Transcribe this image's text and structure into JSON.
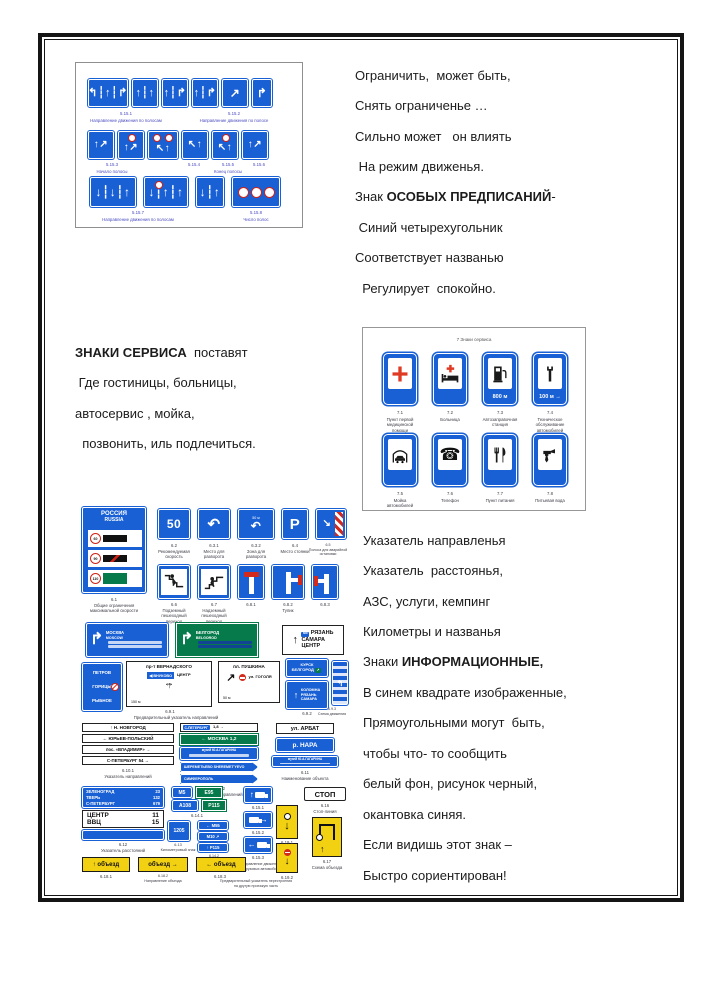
{
  "colors": {
    "sign_blue": "#1960d5",
    "sign_green": "#067a4b",
    "sign_yellow": "#f2d012",
    "cross_red": "#df3a23",
    "frame_black": "#151515"
  },
  "poem_pred": {
    "l1": "Ограничить,  может быть,",
    "l2": "Снять ограниченье …",
    "l3": "Сильно может   он влиять",
    "l4": " На режим движенья.",
    "l5a": "Знак ",
    "l5b": "ОСОБЫХ ПРЕДПИСАНИЙ",
    "l5c": "-",
    "l6": " Синий четырехугольник",
    "l7": "Соответствует названью",
    "l8": "  Регулирует  спокойно."
  },
  "poem_service": {
    "l1a": "ЗНАКИ СЕРВИСА",
    "l1b": "  поставят",
    "l2": " Где гостиницы, больницы,",
    "l3": "автосервис , мойка,",
    "l4": "  позвонить, иль подлечиться."
  },
  "poem_info": {
    "l1": "Указатель направленья",
    "l2": "Указатель  расстоянья,",
    "l3": "АЗС, услуги, кемпинг",
    "l4": "Километры и названья",
    "l5a": "Знаки ",
    "l5b": "ИНФОРМАЦИОННЫЕ,",
    "l6": "В синем квадрате изображенные,",
    "l7": "Прямоугольными могут  быть,",
    "l8": "чтобы что- то сообщить",
    "l9": "белый фон, рисунок черный,",
    "l10": "окантовка синяя.",
    "l11": "Если видишь этот знак –",
    "l12": "Быстро сориентирован!"
  },
  "panel_lanes": {
    "row1": {
      "s1": "↰┆↑┆↱",
      "s2": "↑┆↑",
      "s3": "↑┆↱",
      "s4": "↑┆↱",
      "s5": "↗",
      "s6": "↱",
      "cap1_id": "5.15.1",
      "cap1": "Направление движения по полосам",
      "cap2_id": "5.15.2",
      "cap2": "Направление движения по полосе"
    },
    "row2": {
      "s1": "↑↗",
      "s2": "↑↗",
      "s3": "↖↑",
      "s4": "↖↑",
      "s5": "↖↑",
      "s6": "↑↗",
      "cap1_id": "5.15.3",
      "cap1": "Начало полосы",
      "cap2_id": "5.15.4",
      "cap3_id": "5.15.5",
      "cap3": "Конец полосы",
      "cap4_id": "5.15.6"
    },
    "row3": {
      "s1": "↓┆↓┆↑",
      "s2": "↓┆↑┆↑",
      "s3": "↓┆↑",
      "cap1_id": "5.15.7",
      "cap1": "Направление движения по полосам",
      "cap2_id": "5.15.8",
      "cap2": "Число полос"
    }
  },
  "panel_service": {
    "title": "7 Знаки сервиса",
    "signs": [
      {
        "num": "7.1",
        "name": "Пункт первой\nмедицинской\nпомощи",
        "icon": "medical-cross-icon",
        "extra": ""
      },
      {
        "num": "7.2",
        "name": "Больница",
        "icon": "hospital-bed-icon",
        "extra": ""
      },
      {
        "num": "7.3",
        "name": "Автозаправочная\nстанция",
        "icon": "fuel-pump-icon",
        "extra": "800 м"
      },
      {
        "num": "7.4",
        "name": "Техническое\nобслуживание\nавтомобилей",
        "icon": "wrench-icon",
        "extra": "100 м →"
      },
      {
        "num": "7.5",
        "name": "Мойка\nавтомобилей",
        "icon": "car-wash-icon",
        "extra": ""
      },
      {
        "num": "7.6",
        "name": "Телефон",
        "icon": "telephone-icon",
        "glyph": "☎",
        "extra": ""
      },
      {
        "num": "7.7",
        "name": "Пункт питания",
        "icon": "cutlery-icon",
        "extra": ""
      },
      {
        "num": "7.8",
        "name": "Питьевая вода",
        "icon": "water-tap-icon",
        "extra": ""
      }
    ]
  },
  "panel_info": {
    "rossiya": {
      "line1": "РОССИЯ",
      "line2": "RUSSIA",
      "s1": "60",
      "s2": "90",
      "s3": "110",
      "cap": "6.1\nОбщие ограничения\nмаксимальной скорости"
    },
    "rec_speed": {
      "text": "50",
      "cap": "6.2\nРекомендуемая\nскорость"
    },
    "uturn_place": {
      "glyph": "↶",
      "cap": "6.3.1\nМесто для\nразворота"
    },
    "uturn_zone": {
      "glyph": "↶",
      "dist": "50 м",
      "cap": "6.3.2\nЗона для\nразворота"
    },
    "parking": {
      "text": "P",
      "cap": "6.4\nМесто стоянки"
    },
    "emergency": {
      "glyph": "↘",
      "cap": "6.5\nПолоса для аварийной\nостановки"
    },
    "underpass": {
      "cap": "6.6\nПодземный\nпешеходный\nпереход"
    },
    "overpass": {
      "cap": "6.7\nНадземный\nпешеходный\nпереход"
    },
    "deadend1": {
      "cap": "6.8.1"
    },
    "deadend2": {
      "cap": "6.8.2\nТупик"
    },
    "deadend3": {
      "cap": "6.8.3"
    },
    "adv_blue": {
      "arrow": "↱",
      "city": "МОСКВА",
      "city_lat": "MOSCOW"
    },
    "adv_green": {
      "arrow": "↱",
      "city": "БЕЛГОРОД",
      "city_lat": "BELGOROD"
    },
    "ryazan": {
      "arrow": "↑",
      "tag": "М5",
      "l1": "РЯЗАНЬ",
      "l2": "САМАРА",
      "l3": "ЦЕНТР"
    },
    "petrov": {
      "l1": "ПЕТРОВ",
      "l2": "ГОРИЦЫ",
      "l3": "РЫБНОЕ"
    },
    "vernadsky": {
      "title": "пр-т ВЕРНАДСКОГО",
      "inset": "◀ ВНУКОВО",
      "right": "ЦЕНТР",
      "dist": "150 м",
      "cap_id": "6.9.1",
      "cap": "Предварительный указатель направлений"
    },
    "pushkin": {
      "title": "пл. ПУШКИНА",
      "street": "ул. ГОГОЛЯ",
      "dist": "50 м",
      "arrow": "↗"
    },
    "kursk": {
      "l1": "КУРСК",
      "l2": "БЕЛГОРОД"
    },
    "kolomna": {
      "arrow": "↑",
      "l1": "КОЛОМНА",
      "l2": "РЯЗАНЬ",
      "l3": "САМАРА",
      "cap": "6.9.2"
    },
    "scheme": {
      "cap": "6.9.3\nСхема движения"
    },
    "dir_white": {
      "l1": "↑  Н. НОВГОРОД",
      "l2": "←  ЮРЬЕВ-ПОЛЬСКИЙ",
      "l3": "пос. «ВЛАДИМИР»  →",
      "l4": "С-ПЕТЕРБУРГ 54  →",
      "cap": "6.10.1\nУказатель направлений"
    },
    "dir_mid": {
      "spb": "С-ПЕТЕРБУРГ",
      "spb_km": "1,8 →",
      "moscow": "← МОСКВА 1,2",
      "sher": "ШЕРЕМЕТЬЕВО SHEREMET'YEVO",
      "simf": "СИМФЕРОПОЛЬ",
      "cap": "6.10.2\nУказатель направлений"
    },
    "names": {
      "arbat": "ул. АРБАТ",
      "nara": "р. НАРА",
      "gagarin": "музей Ю.А.ГАГАРИНА",
      "cap": "6.11\nНаименование объекта"
    },
    "distances": {
      "n1": "ЗЕЛЕНОГРАД",
      "v1": "23",
      "n2": "ТВЕРЬ",
      "v2": "132",
      "n3": "С-ПЕТЕРБУРГ",
      "v3": "679",
      "cap": "6.12\nУказатель расстояний"
    },
    "centr": {
      "r1": "ЦЕНТР",
      "k1": "11",
      "r2": "ВВЦ",
      "k2": "15"
    },
    "km": {
      "text": "1205",
      "cap": "6.13\nКилометровый знак"
    },
    "routes": {
      "r1": "М5",
      "r2": "Е95",
      "r3": "А108",
      "r4": "Р115",
      "cap1": "6.14.1",
      "a1": "← М55",
      "a2": "М10 ↗",
      "a3": "↑ Р115",
      "cap2": "6.14.2\nНомер маршрута"
    },
    "trucks": {
      "cap1": "6.15.1",
      "cap2": "6.15.2",
      "cap3": "6.15.3",
      "cap": "Направление движения\nдля грузовых автомобилей"
    },
    "stop": {
      "text": "СТОП",
      "cap": "6.16\nСтоп-линия"
    },
    "detour_scheme": {
      "cap": "6.17\nСхема объезда"
    },
    "detours": {
      "t1": "↑ объезд",
      "t2": "объезд →",
      "t3": "← объезд",
      "cap1": "6.18.1",
      "cap2": "6.18.2\nНаправление объезда",
      "cap3": "6.18.3"
    },
    "shift": {
      "g1": "↓",
      "g2": "↓",
      "cap1": "6.19.1",
      "cap2": "6.19.2",
      "cap": "Предварительный указатель перестроения\nна другую проезжую часть"
    }
  }
}
